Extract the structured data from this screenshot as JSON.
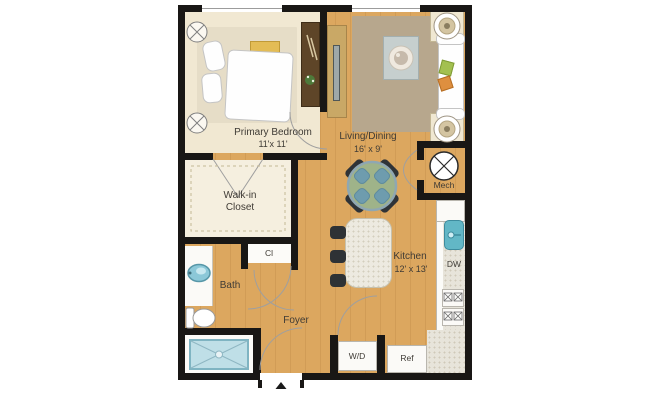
{
  "rooms": {
    "bedroom": {
      "name": "Primary Bedroom",
      "dims": "11'x 11'"
    },
    "living": {
      "name": "Living/Dining",
      "dims": "16' x 9'"
    },
    "kitchen": {
      "name": "Kitchen",
      "dims": "12' x 13'"
    },
    "closet": {
      "line1": "Walk-in",
      "line2": "Closet"
    },
    "bath": {
      "name": "Bath"
    },
    "foyer": {
      "name": "Foyer"
    },
    "cl": {
      "name": "Cl"
    },
    "mech": {
      "name": "Mech"
    }
  },
  "appliances": {
    "washer_dryer": "W/D",
    "refrigerator": "Ref",
    "dishwasher": "DW"
  },
  "colors": {
    "wall": "#191715",
    "wood_floor": "#dca75f",
    "bedroom_floor": "#f1e8d2",
    "granite_counter": "#e7e4da",
    "shower": "#bfdfe7",
    "sink": "#62b7c6",
    "dining_table": "#9fb389",
    "pillow_green": "#a3c050",
    "pillow_orange": "#de8f3f",
    "rug": "#b7a78d"
  }
}
